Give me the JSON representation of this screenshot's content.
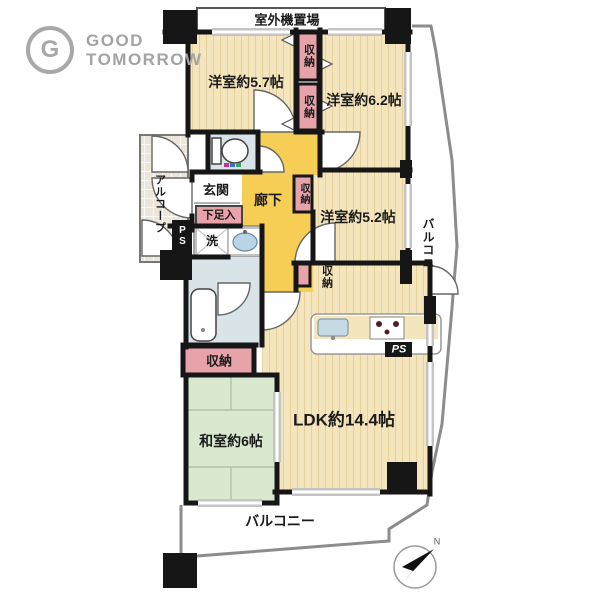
{
  "logo": {
    "icon_letter": "G",
    "line1": "GOOD",
    "line2": "TOMORROW"
  },
  "plan": {
    "outdoor_unit": "室外機置場",
    "rooms": {
      "western57": "洋室約5.7帖",
      "western62": "洋室約6.2帖",
      "western52": "洋室約5.2帖",
      "ldk": "LDK約14.4帖",
      "japanese": "和室約6帖",
      "hallway": "廊下",
      "entrance": "玄関",
      "alcove": "アルコープ"
    },
    "fixtures": {
      "closet": "収納",
      "shoe_cabinet": "下足入",
      "laundry": "洗",
      "pipe_shaft": "PS"
    },
    "balcony": "バルコニー",
    "compass_north": "N"
  },
  "colors": {
    "wood_floor": "#f4e5bd",
    "tatami": "#d9e9d0",
    "closet_pink": "#e8a2aa",
    "corridor_yellow": "#f7ce55",
    "water_blue": "#d8e4e8",
    "wall_black": "#161616",
    "balcony_line": "#8c8c8c",
    "logo_gray": "#a8a8a8"
  }
}
